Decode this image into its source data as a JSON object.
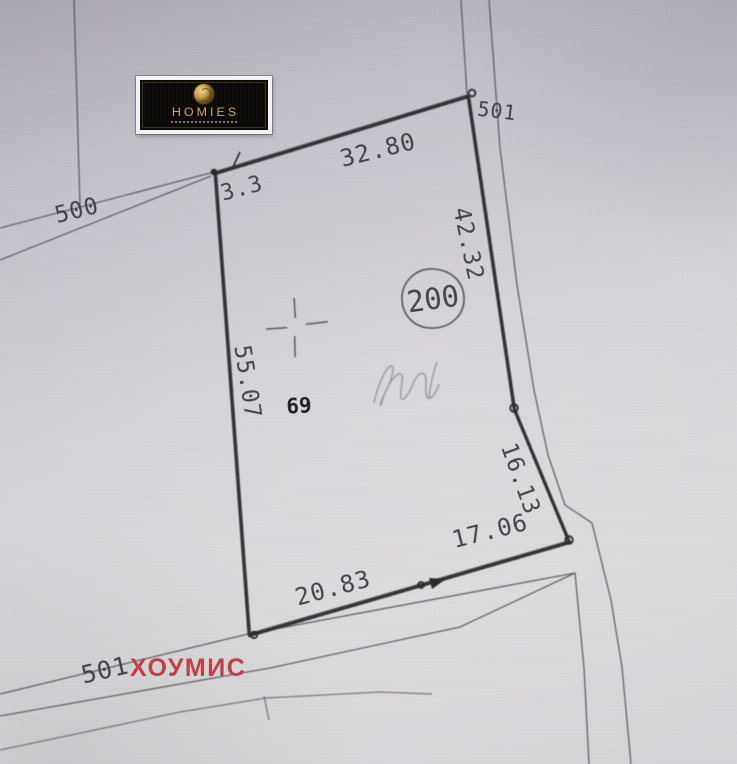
{
  "logo": {
    "brand": "HOMIES"
  },
  "watermark": {
    "text": "ХОУМИС",
    "color": "#bf4046"
  },
  "parcel": {
    "number": "200",
    "secondary_number": "69"
  },
  "roads": {
    "left": "500",
    "top_right": "501",
    "bottom": "501"
  },
  "measurements": {
    "top": "32.80",
    "top_left": "3.3",
    "right_upper": "42.32",
    "right_lower": "16.13",
    "bottom_right": "17.06",
    "bottom_left": "20.83",
    "left": "55.07"
  },
  "colors": {
    "ink": "#3a373e",
    "boundary": "#2c2a2d",
    "watermark_red": "#bf4046",
    "logo_gold": "#c9a456",
    "logo_background": "#0c0a09"
  }
}
